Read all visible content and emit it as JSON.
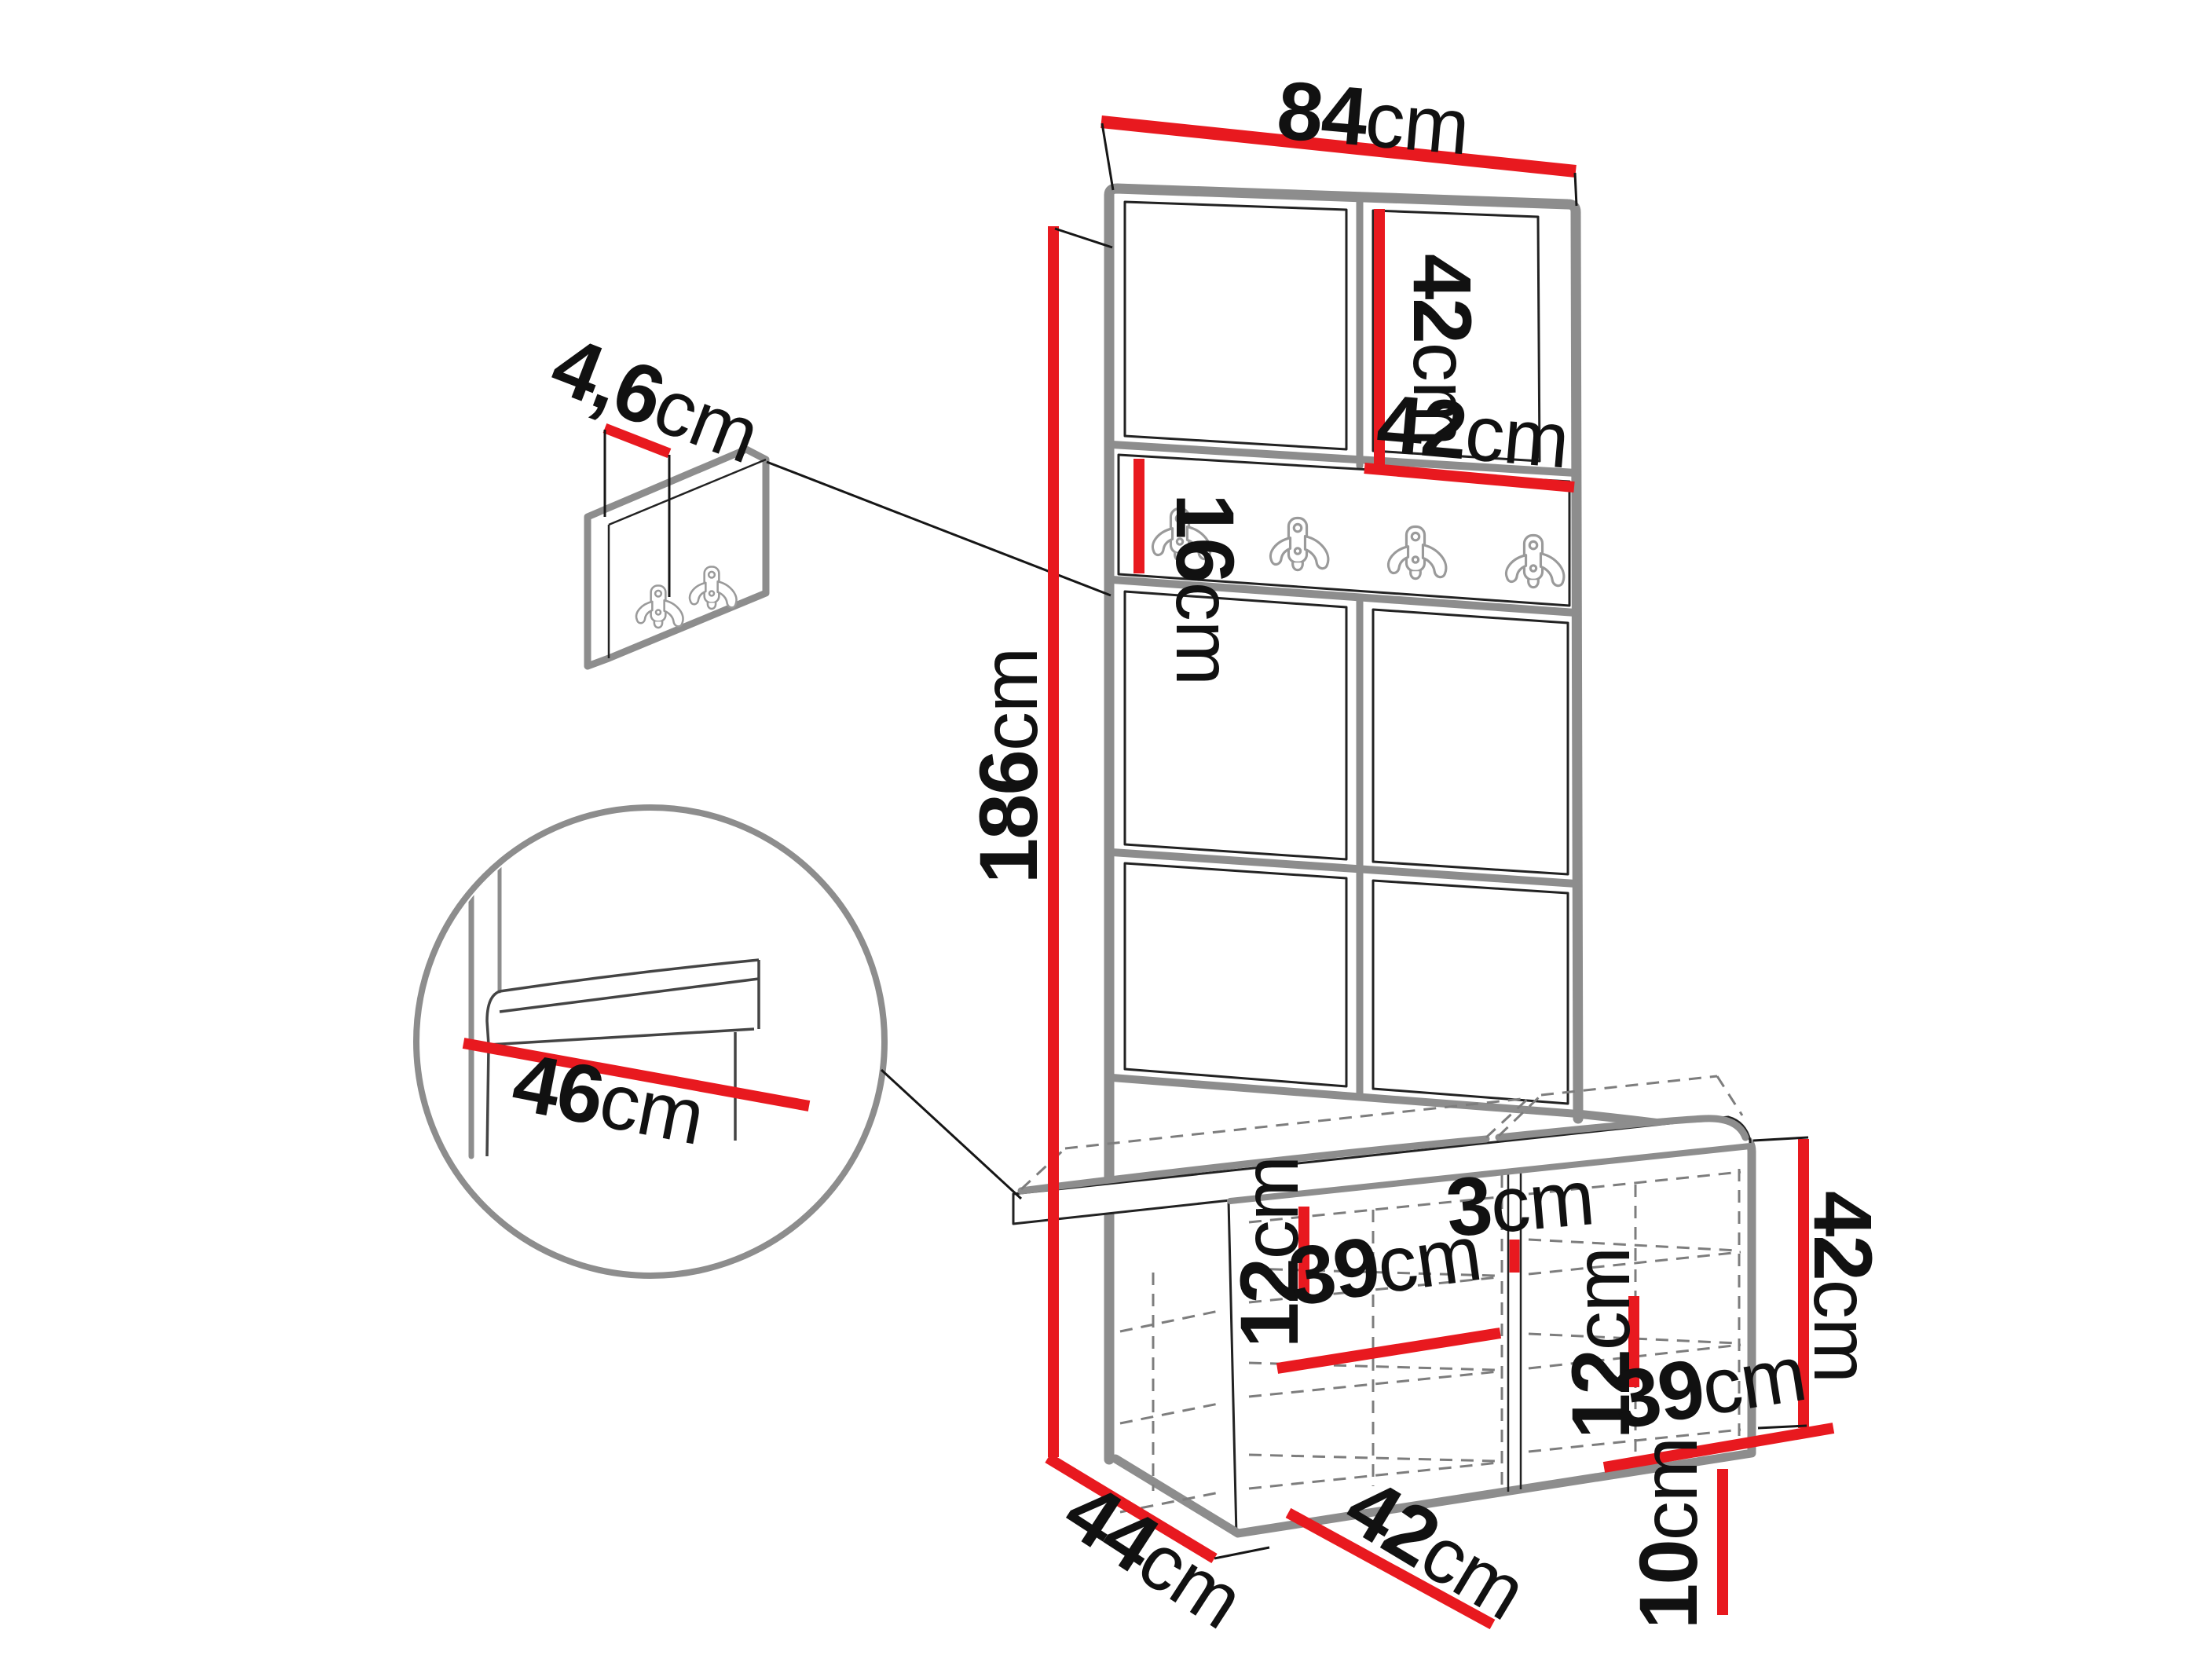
{
  "diagram": {
    "subject": "hallway-unit-dimension-drawing",
    "colors": {
      "dimension_line": "#e8191f",
      "structure_gray": "#8d8d8d",
      "edge_black": "#1c1c1c",
      "background": "#ffffff"
    },
    "hook_rail": {
      "hook_count": 4
    },
    "wall_panel_detail": {
      "hook_count": 2
    },
    "labels": {
      "width_top": {
        "value": "84",
        "unit": "cm"
      },
      "panel_col_height": {
        "value": "42",
        "unit": "cm"
      },
      "panel_col_width": {
        "value": "42",
        "unit": "cm"
      },
      "rail_height": {
        "value": "16",
        "unit": "cm"
      },
      "total_height": {
        "value": "186",
        "unit": "cm"
      },
      "panel_thickness": {
        "value": "4,6",
        "unit": "cm"
      },
      "seat_depth": {
        "value": "46",
        "unit": "cm"
      },
      "divider_thickness": {
        "value": "3",
        "unit": "cm"
      },
      "shelf_gap_left": {
        "value": "12",
        "unit": "cm"
      },
      "compartment_width_left": {
        "value": "39",
        "unit": "cm"
      },
      "shelf_gap_right": {
        "value": "12",
        "unit": "cm"
      },
      "compartment_width_right": {
        "value": "39",
        "unit": "cm"
      },
      "door_width": {
        "value": "42",
        "unit": "cm"
      },
      "plinth_height": {
        "value": "10",
        "unit": "cm"
      },
      "bench_height": {
        "value": "42",
        "unit": "cm"
      },
      "depth": {
        "value": "44",
        "unit": "cm"
      }
    }
  }
}
